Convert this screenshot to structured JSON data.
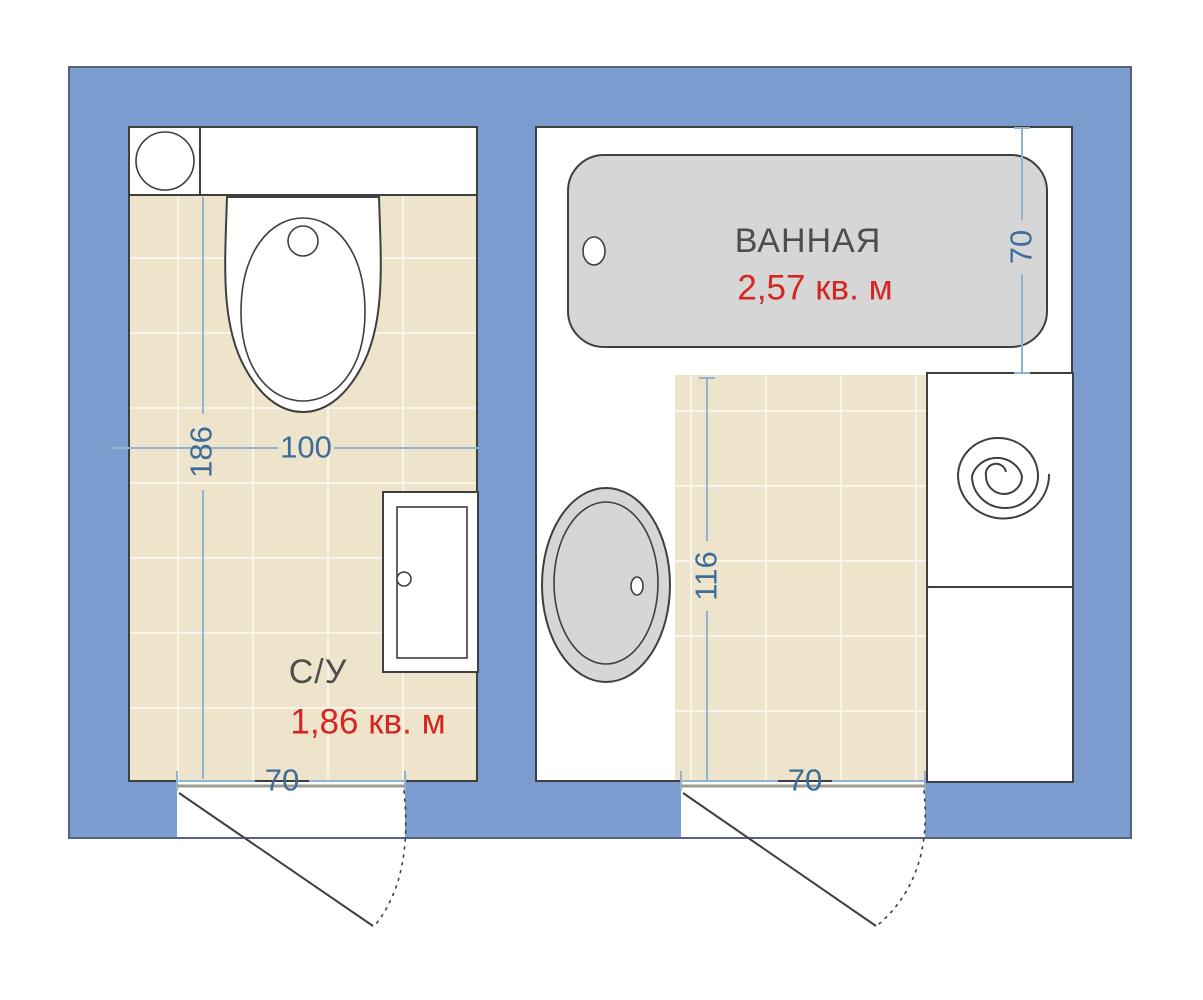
{
  "toilet_room": {
    "label": "С/У",
    "area": "1,86 кв. м",
    "dim_height": "186",
    "dim_width": "100",
    "dim_door": "70"
  },
  "bathroom": {
    "label": "ВАННАЯ",
    "area": "2,57 кв. м",
    "dim_bath_width": "70",
    "dim_inner_height": "116",
    "dim_door": "70"
  },
  "colors": {
    "wall": "#7A9CCE",
    "floor": "#EDE4CB",
    "tile_line": "#F8F4E9",
    "fixture": "#D6D6D6",
    "outline": "#3F3F3F",
    "dim_line": "#8FB3D1",
    "dim_text": "#3E6C99",
    "area_text": "#D42622",
    "label_text": "#4D4D4D",
    "threshold": "#9C9C90"
  }
}
